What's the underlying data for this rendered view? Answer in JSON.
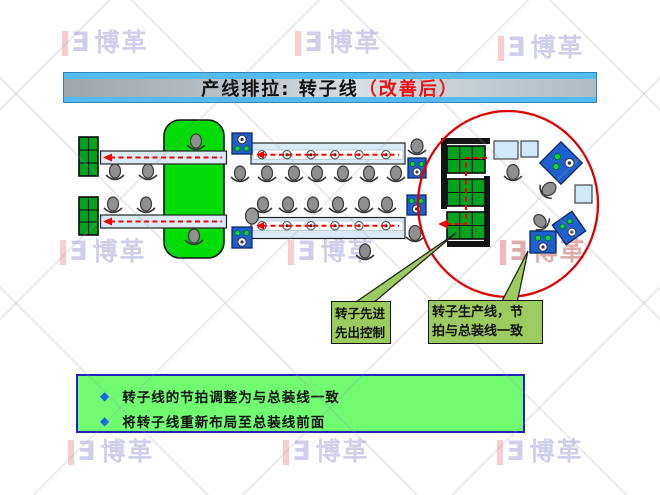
{
  "title": {
    "prefix": "产线排拉: 转子线",
    "highlight": "（改善后）"
  },
  "watermark": {
    "mark_glyph": "Ǝ",
    "text": "博革"
  },
  "callouts": {
    "fifo": {
      "line1": "转子先进",
      "line2": "先出控制"
    },
    "takt": {
      "line1": "转子生产线，节",
      "line2": "拍与总装线一致"
    }
  },
  "summary": {
    "bullet_glyph": "◆",
    "items": [
      "转子线的节拍调整为与总装线一致",
      "将转子线重新布局至总装线前面"
    ]
  },
  "colors": {
    "title_highlight_red": "#E81010",
    "title_bar_blue": "#55BAEF",
    "callout_green": "#9CCB5F",
    "summary_green": "#70FB70",
    "summary_border_blue": "#2222BB",
    "table_green": "#00A31E",
    "buffer_green": "#00DC05",
    "machine_blue": "#1F5FD0",
    "conveyor_blue": "#D9EAF6",
    "flow_red": "#F40000",
    "highlight_circle_red": "#E00000"
  }
}
